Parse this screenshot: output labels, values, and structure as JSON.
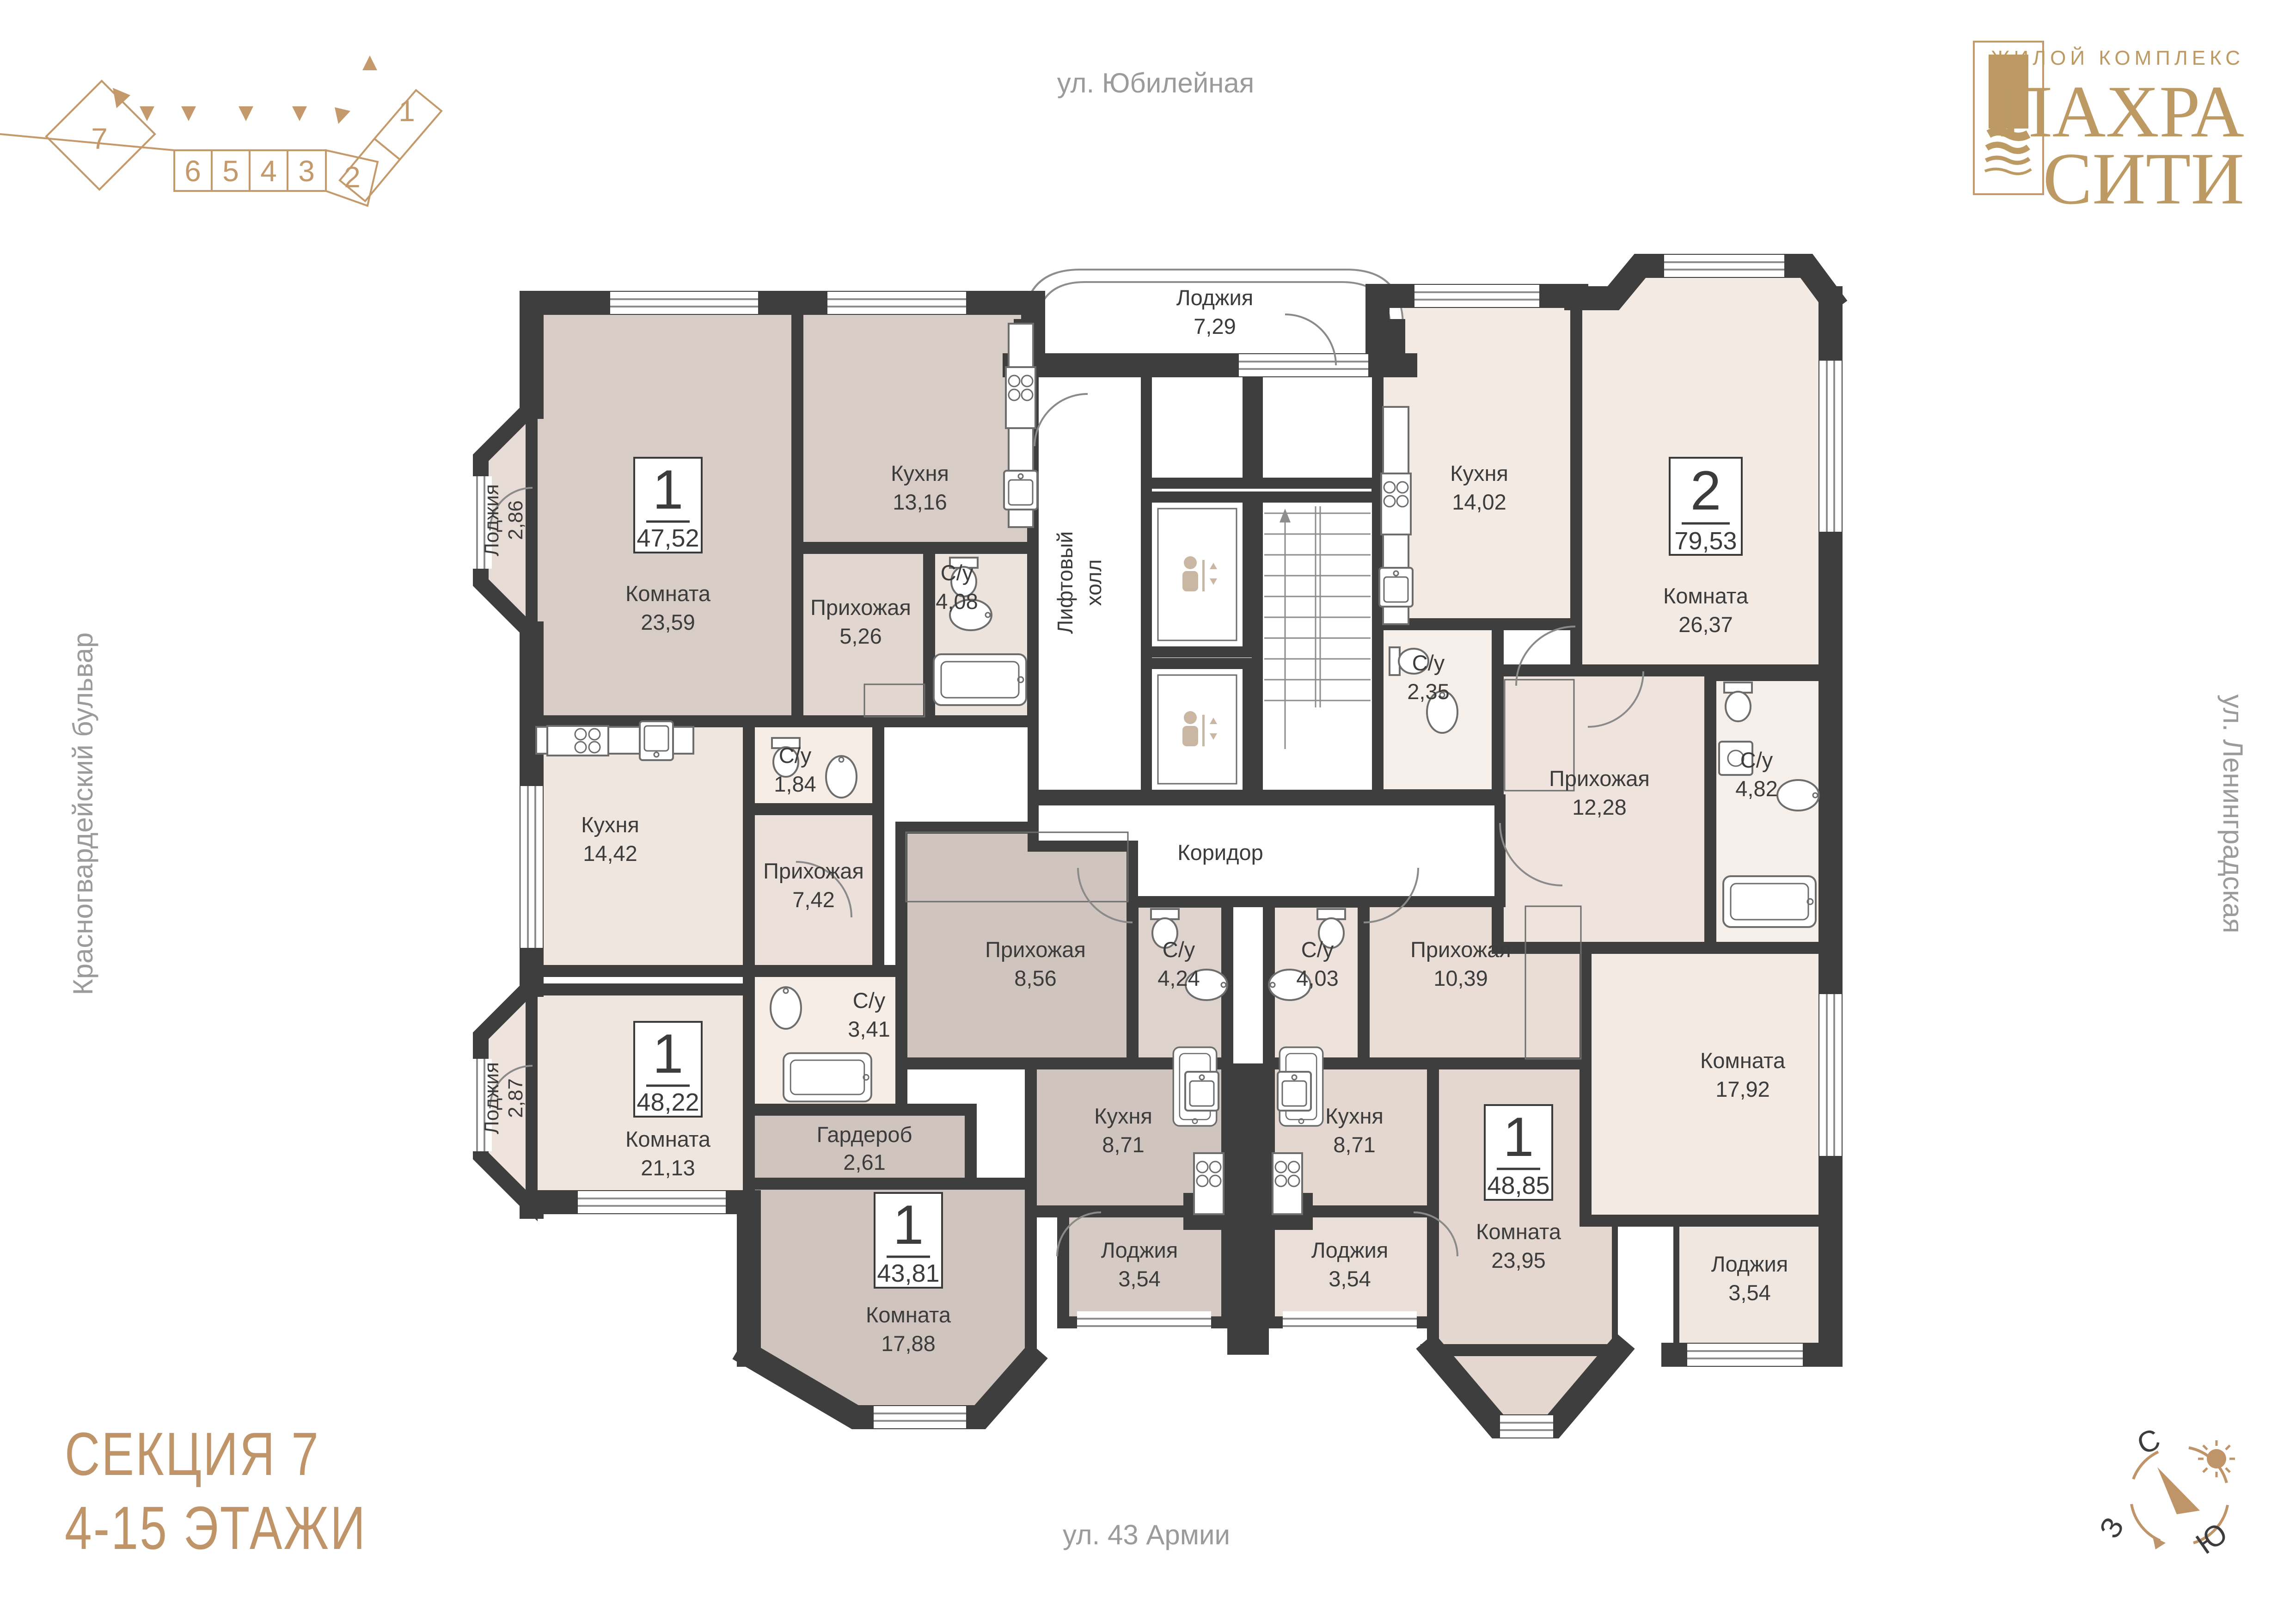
{
  "header": {
    "streets": {
      "top": "ул. Юбилейная",
      "right": "ул. Ленинградская",
      "bottom": "ул. 43 Армии",
      "left": "Красногвардейский бульвар"
    },
    "logo": {
      "tagline": "ЖИЛОЙ КОМПЛЕКС",
      "line1": "ПАХРА",
      "line2": "СИТИ"
    },
    "section_diagram": {
      "numbers": [
        "7",
        "6",
        "5",
        "4",
        "3",
        "2",
        "1"
      ]
    }
  },
  "footer": {
    "section_title": "СЕКЦИЯ 7",
    "floors": "4-15 ЭТАЖИ"
  },
  "compass": {
    "north": "С",
    "west": "З",
    "south": "Ю"
  },
  "plan": {
    "common": {
      "top_loggia": {
        "name": "Лоджия",
        "area": "7,29"
      },
      "elevator_hall": {
        "line1": "Лифтовый",
        "line2": "холл"
      },
      "corridor": "Коридор"
    },
    "apartments": [
      {
        "type": "1",
        "area": "47,52",
        "rooms": [
          {
            "name": "Комната",
            "area": "23,59"
          },
          {
            "name": "Кухня",
            "area": "13,16"
          },
          {
            "name": "Прихожая",
            "area": "5,26"
          },
          {
            "name": "С/у",
            "area": "4,08"
          },
          {
            "name": "Лоджия",
            "area": "2,86"
          }
        ]
      },
      {
        "type": "2",
        "area": "79,53",
        "rooms": [
          {
            "name": "Кухня",
            "area": "14,02"
          },
          {
            "name": "Комната",
            "area": "26,37"
          },
          {
            "name": "С/у",
            "area": "2,35"
          },
          {
            "name": "Прихожая",
            "area": "12,28"
          },
          {
            "name": "С/у",
            "area": "4,82"
          },
          {
            "name": "Комната",
            "area": "17,92"
          },
          {
            "name": "Лоджия",
            "area": "3,54"
          }
        ]
      },
      {
        "type": "1",
        "area": "48,22",
        "rooms": [
          {
            "name": "Кухня",
            "area": "14,42"
          },
          {
            "name": "С/у",
            "area": "1,84"
          },
          {
            "name": "Прихожая",
            "area": "7,42"
          },
          {
            "name": "С/у",
            "area": "3,41"
          },
          {
            "name": "Комната",
            "area": "21,13"
          },
          {
            "name": "Лоджия",
            "area": "2,87"
          }
        ]
      },
      {
        "type": "1",
        "area": "43,81",
        "rooms": [
          {
            "name": "Прихожая",
            "area": "8,56"
          },
          {
            "name": "С/у",
            "area": "4,24"
          },
          {
            "name": "Гардероб",
            "area": "2,61"
          },
          {
            "name": "Кухня",
            "area": "8,71"
          },
          {
            "name": "Комната",
            "area": "17,88"
          },
          {
            "name": "Лоджия",
            "area": "3,54"
          }
        ]
      },
      {
        "type": "1",
        "area": "48,85",
        "rooms": [
          {
            "name": "С/у",
            "area": "4,03"
          },
          {
            "name": "Прихожая",
            "area": "10,39"
          },
          {
            "name": "Кухня",
            "area": "8,71"
          },
          {
            "name": "Комната",
            "area": "23,95"
          },
          {
            "name": "Лоджия",
            "area": "3,54"
          }
        ]
      }
    ]
  },
  "colors": {
    "wall": "#3e3e3e",
    "brand_gold": "#bd9a63",
    "diagram_gold": "#c49a6c",
    "street_text": "#9b9b9b",
    "apt1_fill": "#d8cdc6",
    "apt2_fill": "#f3eae4",
    "apt3_fill": "#f0e6e0",
    "apt4_fill": "#cfc5be",
    "apt5_fill": "#e3d7d0"
  }
}
